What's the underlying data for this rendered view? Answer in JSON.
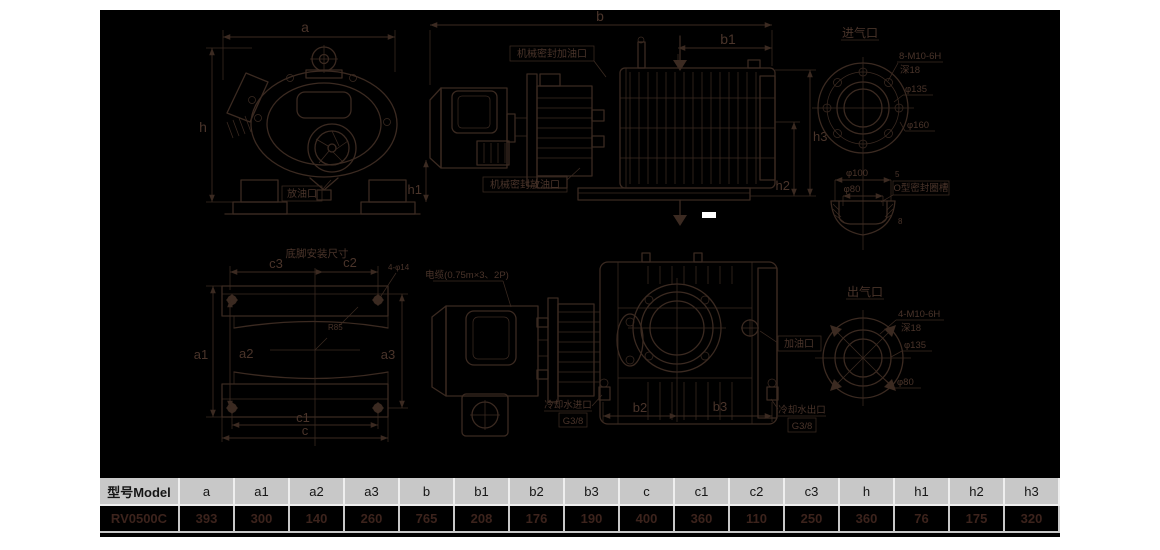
{
  "drawings": {
    "front_view": {
      "dim_a": "a",
      "dim_h": "h",
      "drain_port": "放油口"
    },
    "top_side_view": {
      "dim_b": "b",
      "dim_b1": "b1",
      "dim_h1": "h1",
      "dim_h2": "h2",
      "dim_h3": "h3",
      "seal_fill": "机械密封加油口",
      "seal_drain": "机械密封放油口"
    },
    "inlet_port": {
      "title": "进气口",
      "bolt_spec": "8-M10-6H",
      "depth": "深18",
      "dia_bolt_circle": "φ135",
      "dia_outer": "φ160"
    },
    "oring_groove": {
      "dia_100": "φ100",
      "dia_80": "φ80",
      "dim_5": "5",
      "dim_8": "8",
      "label": "O型密封圈槽"
    },
    "outlet_port": {
      "title": "出气口",
      "bolt_spec": "4-M10-6H",
      "depth": "深18",
      "dia_bolt_circle": "φ135",
      "dia_bore": "φ80"
    },
    "foot_plan": {
      "title": "底脚安装尺寸",
      "dim_c3": "c3",
      "dim_c2": "c2",
      "hole_spec": "4-φ14",
      "fillet": "R85",
      "dim_a1": "a1",
      "dim_a2": "a2",
      "dim_a3": "a3",
      "dim_c1": "c1",
      "dim_c": "c"
    },
    "bottom_side_view": {
      "cable": "电缆(0.75m×3、2P)",
      "oil_fill": "加油口",
      "water_in": "冷却水进口",
      "water_in_thread": "G3/8",
      "water_out": "冷却水出口",
      "water_out_thread": "G3/8",
      "dim_b2": "b2",
      "dim_b3": "b3"
    }
  },
  "table": {
    "headers": [
      "型号Model",
      "a",
      "a1",
      "a2",
      "a3",
      "b",
      "b1",
      "b2",
      "b3",
      "c",
      "c1",
      "c2",
      "c3",
      "h",
      "h1",
      "h2",
      "h3"
    ],
    "rows": [
      [
        "RV0500C",
        "393",
        "300",
        "140",
        "260",
        "765",
        "208",
        "176",
        "190",
        "400",
        "360",
        "110",
        "250",
        "360",
        "76",
        "175",
        "320"
      ]
    ]
  },
  "colors": {
    "panel_bg": "#000000",
    "line": "#3b2a21",
    "value_text": "#3c231c",
    "header_bg": "#c8c8c8"
  }
}
